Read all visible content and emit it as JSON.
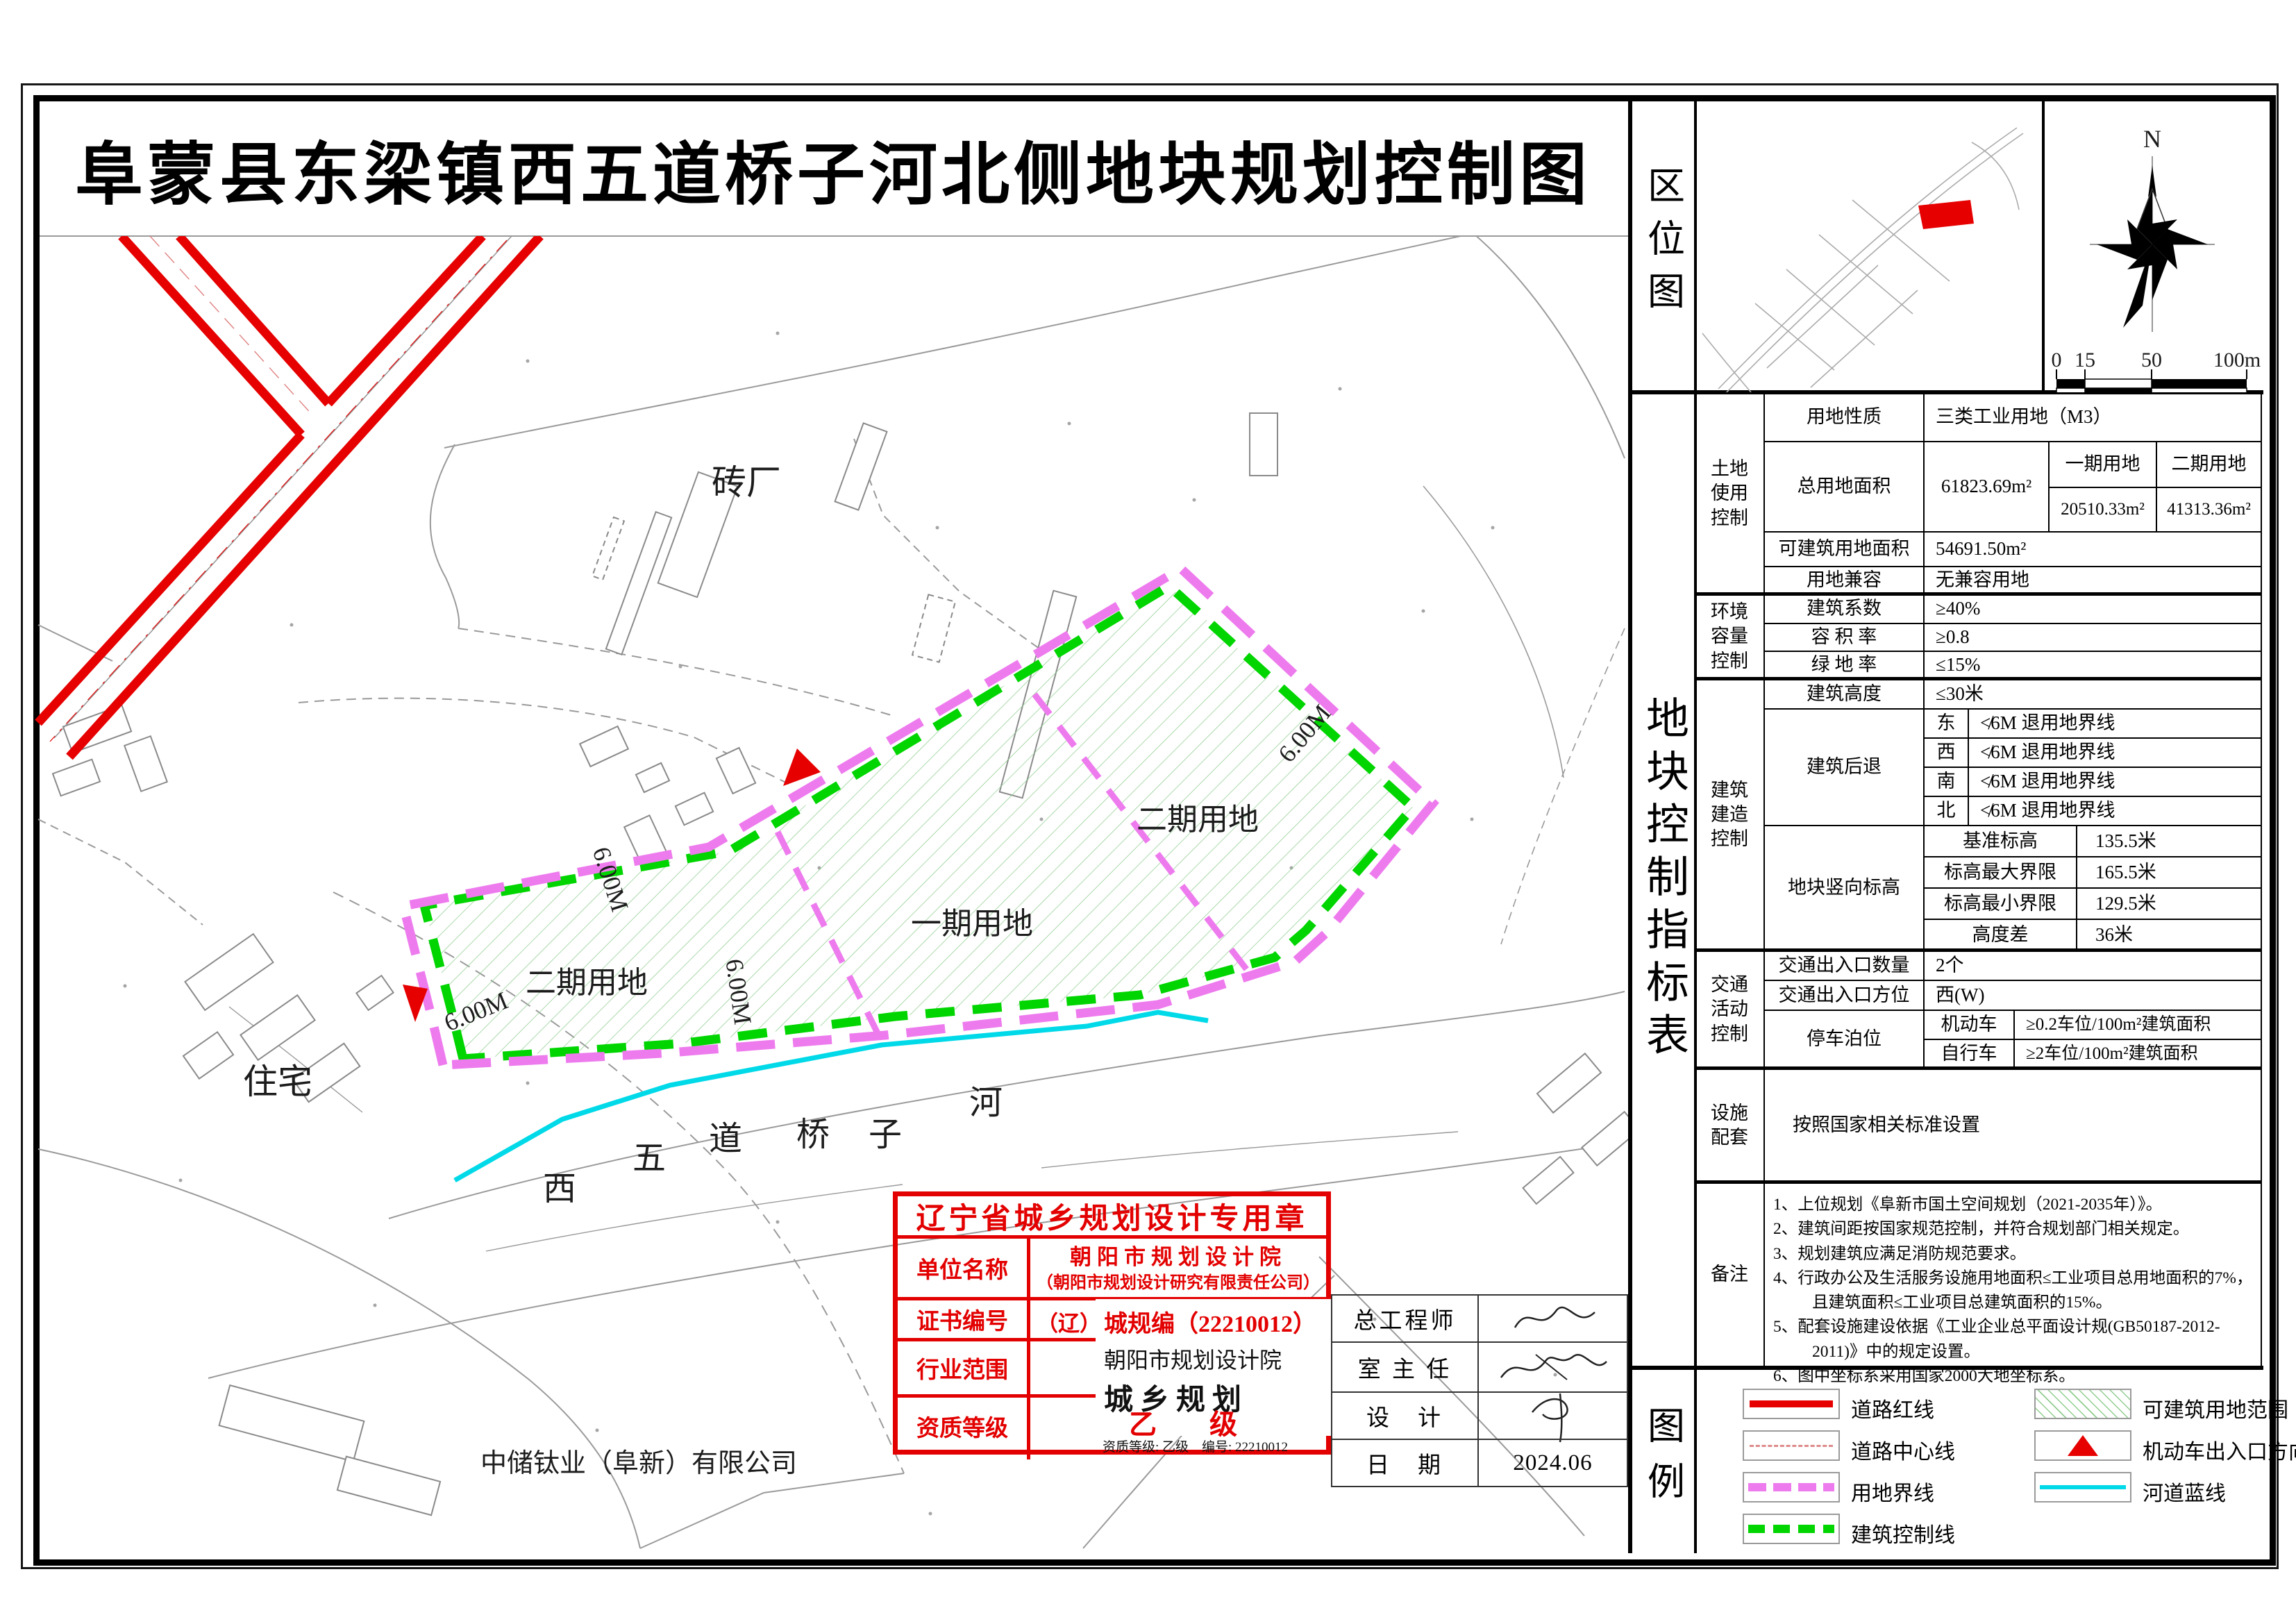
{
  "title": "阜蒙县东梁镇西五道桥子河北侧地块规划控制图",
  "location": {
    "label": "区位图",
    "north": "N",
    "scale_ticks": [
      "0",
      "15",
      "50",
      "100m"
    ]
  },
  "table": {
    "label": "地块控制指标表",
    "land_use_group": "土地\n使用\n控制",
    "env_group": "环境\n容量\n控制",
    "build_group": "建筑\n建造\n控制",
    "traffic_group": "交通\n活动\n控制",
    "facility_group": "设施\n配套",
    "notes_group": "备注",
    "nature_label": "用地性质",
    "nature_value": "三类工业用地（M3）",
    "total_label": "总用地面积",
    "total_value": "61823.69m²",
    "phase1_label": "一期用地",
    "phase2_label": "二期用地",
    "phase1_value": "20510.33m²",
    "phase2_value": "41313.36m²",
    "buildable_label": "可建筑用地面积",
    "buildable_value": "54691.50m²",
    "compat_label": "用地兼容",
    "compat_value": "无兼容用地",
    "coeff_label": "建筑系数",
    "coeff_value": "≥40%",
    "far_label": "容 积 率",
    "far_value": "≥0.8",
    "green_label": "绿 地 率",
    "green_value": "≤15%",
    "height_label": "建筑高度",
    "height_value": "≤30米",
    "setback_label": "建筑后退",
    "setback_dirs": [
      {
        "dir": "东",
        "value": "≮6M 退用地界线"
      },
      {
        "dir": "西",
        "value": "≮6M 退用地界线"
      },
      {
        "dir": "南",
        "value": "≮6M 退用地界线"
      },
      {
        "dir": "北",
        "value": "≮6M 退用地界线"
      }
    ],
    "elev_label": "地块竖向标高",
    "elev_items": [
      {
        "label": "基准标高",
        "value": "135.5米"
      },
      {
        "label": "标高最大界限",
        "value": "165.5米"
      },
      {
        "label": "标高最小界限",
        "value": "129.5米"
      },
      {
        "label": "高度差",
        "value": "36米"
      }
    ],
    "entry_count_label": "交通出入口数量",
    "entry_count_value": "2个",
    "entry_dir_label": "交通出入口方位",
    "entry_dir_value": "西(W)",
    "parking_label": "停车泊位",
    "parking_items": [
      {
        "label": "机动车",
        "value": "≥0.2车位/100m²建筑面积"
      },
      {
        "label": "自行车",
        "value": "≥2车位/100m²建筑面积"
      }
    ],
    "facility_value": "按照国家相关标准设置",
    "notes": [
      "1、上位规划《阜新市国土空间规划（2021-2035年）》。",
      "2、建筑间距按国家规范控制，并符合规划部门相关规定。",
      "3、规划建筑应满足消防规范要求。",
      "4、行政办公及生活服务设施用地面积≤工业项目总用地面积的7%，且建筑面积≤工业项目总建筑面积的15%。",
      "5、配套设施建设依据《工业企业总平面设计规(GB50187-2012-2011)》中的规定设置。",
      "6、图中坐标系采用国家2000大地坐标系。"
    ]
  },
  "legend": {
    "label": "图例",
    "items": [
      {
        "name": "road-red-line",
        "label": "道路红线"
      },
      {
        "name": "road-center-line",
        "label": "道路中心线"
      },
      {
        "name": "land-boundary-line",
        "label": "用地界线"
      },
      {
        "name": "building-control-line",
        "label": "建筑控制线"
      },
      {
        "name": "buildable-area",
        "label": "可建筑用地范围"
      },
      {
        "name": "vehicle-entrance",
        "label": "机动车出入口方向"
      },
      {
        "name": "river-blue-line",
        "label": "河道蓝线"
      }
    ]
  },
  "map": {
    "brick_factory": "砖厂",
    "residential": "住宅",
    "phase1": "一期用地",
    "phase2": "二期用地",
    "setback_6m": "6.00M",
    "river_chars": [
      "西",
      "五",
      "道",
      "桥",
      "子",
      "河"
    ],
    "company": "中储钛业（阜新）有限公司"
  },
  "stamp": {
    "title": "辽宁省城乡规划设计专用章",
    "unit_label": "单位名称",
    "unit_value": "朝阳市规划设计院",
    "unit_value2": "（朝阳市规划设计研究有限责任公司）",
    "cert_label": "证书编号",
    "cert_prefix": "（辽）",
    "cert_value": "城规编（22210012）",
    "scope_label": "行业范围",
    "scope_unit": "朝阳市规划设计院",
    "scope_value": "城乡规划",
    "grade_label": "资质等级",
    "grade_value": "乙　级",
    "qualification_line": "资质等级: 乙级　编号: 22210012"
  },
  "titleblock": {
    "chief_label": "总工程师",
    "director_label": "室 主 任",
    "designer_label": "设　计",
    "date_label": "日　期",
    "date_value": "2024.06"
  },
  "colors": {
    "road_red": "#e60000",
    "boundary_magenta": "#ee7bee",
    "control_green": "#00d500",
    "river_cyan": "#00d9e8",
    "stamp_red": "#e30000",
    "hatch_green": "#8fcd8f"
  }
}
